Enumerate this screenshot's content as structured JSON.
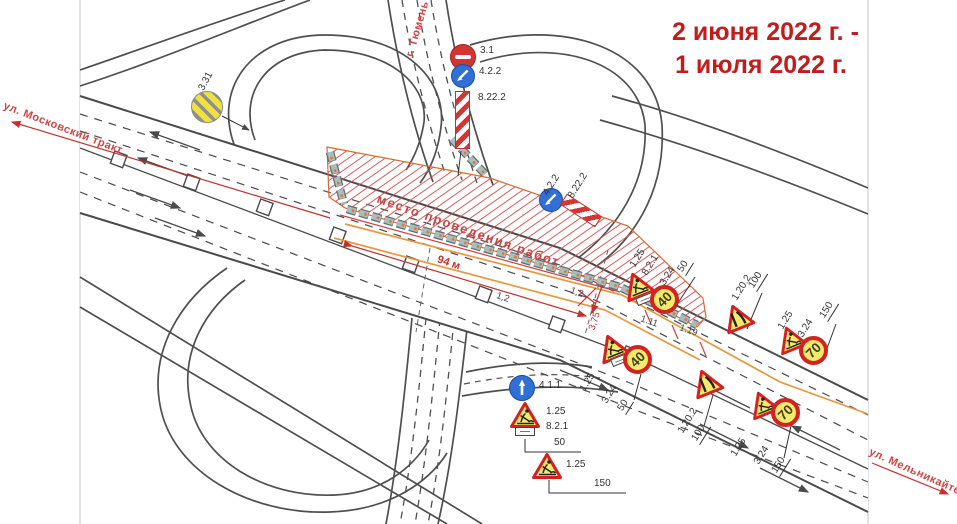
{
  "dates": {
    "line1": "2 июня 2022 г. -",
    "line2": "1 июля 2022 г."
  },
  "streets": {
    "moskovsky": "ул. Московский тракт",
    "melnikayte": "ул. Мельникайте",
    "tyumen": "г. Тюмень"
  },
  "work_zone_label": "место проведения работ",
  "markings": {
    "length": "94 м",
    "offset1": "1,2",
    "offset2": "1,2",
    "lane_width": "3,75",
    "line_code1": "1.11",
    "line_code2": "1.19"
  },
  "signs": {
    "end_restrictions": "3.31",
    "top_post": {
      "no_entry": "3.1",
      "detour": "4.2.2",
      "panel": "8.22.2"
    },
    "zone_end": {
      "detour": "4.2.2",
      "panel": "8.22.2"
    },
    "upper_approach": {
      "works": "1.25",
      "zone_plate": "8.2.1",
      "speed": "3.24",
      "speed_value": "40",
      "distance": "50"
    },
    "upper_narrowing": {
      "narrowing": "1.20.2",
      "distance": "100"
    },
    "upper_advance": {
      "works": "1.25",
      "speed": "3.24",
      "speed_value": "70",
      "distance": "150"
    },
    "lower_approach": {
      "works": "1.25",
      "zone_plate": "8.2.1",
      "speed": "3.24",
      "speed_value": "40",
      "distance": "50"
    },
    "lower_narrowing": {
      "narrowing": "1.20.2",
      "distance": "100"
    },
    "lower_advance": {
      "works": "1.25",
      "speed": "3.24",
      "speed_value": "70",
      "distance": "150"
    },
    "straight_ahead": "4.1.1",
    "side_works_near": {
      "works": "1.25",
      "zone_plate": "8.2.1",
      "distance": "50"
    },
    "side_works_far": {
      "works": "1.25",
      "distance": "150"
    }
  }
}
